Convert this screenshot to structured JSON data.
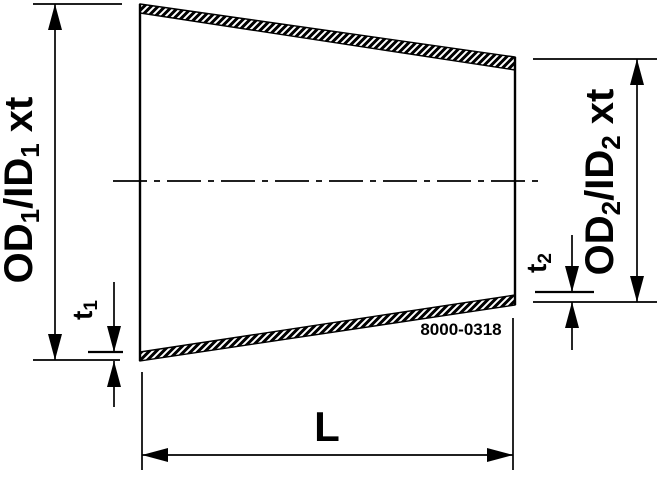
{
  "figure_number": "8000-0318",
  "labels": {
    "od1": {
      "p1": "OD",
      "s1": "1",
      "p2": "/ID",
      "s2": "1",
      "p3": "xt"
    },
    "t1": {
      "p1": "t",
      "s1": "1"
    },
    "od2": {
      "p1": "OD",
      "s1": "2",
      "p2": "/ID",
      "s2": "2",
      "p3": "xt"
    },
    "t2": {
      "p1": "t",
      "s1": "2"
    },
    "length": "L"
  },
  "colors": {
    "ink": "#000000",
    "background": "#ffffff"
  }
}
